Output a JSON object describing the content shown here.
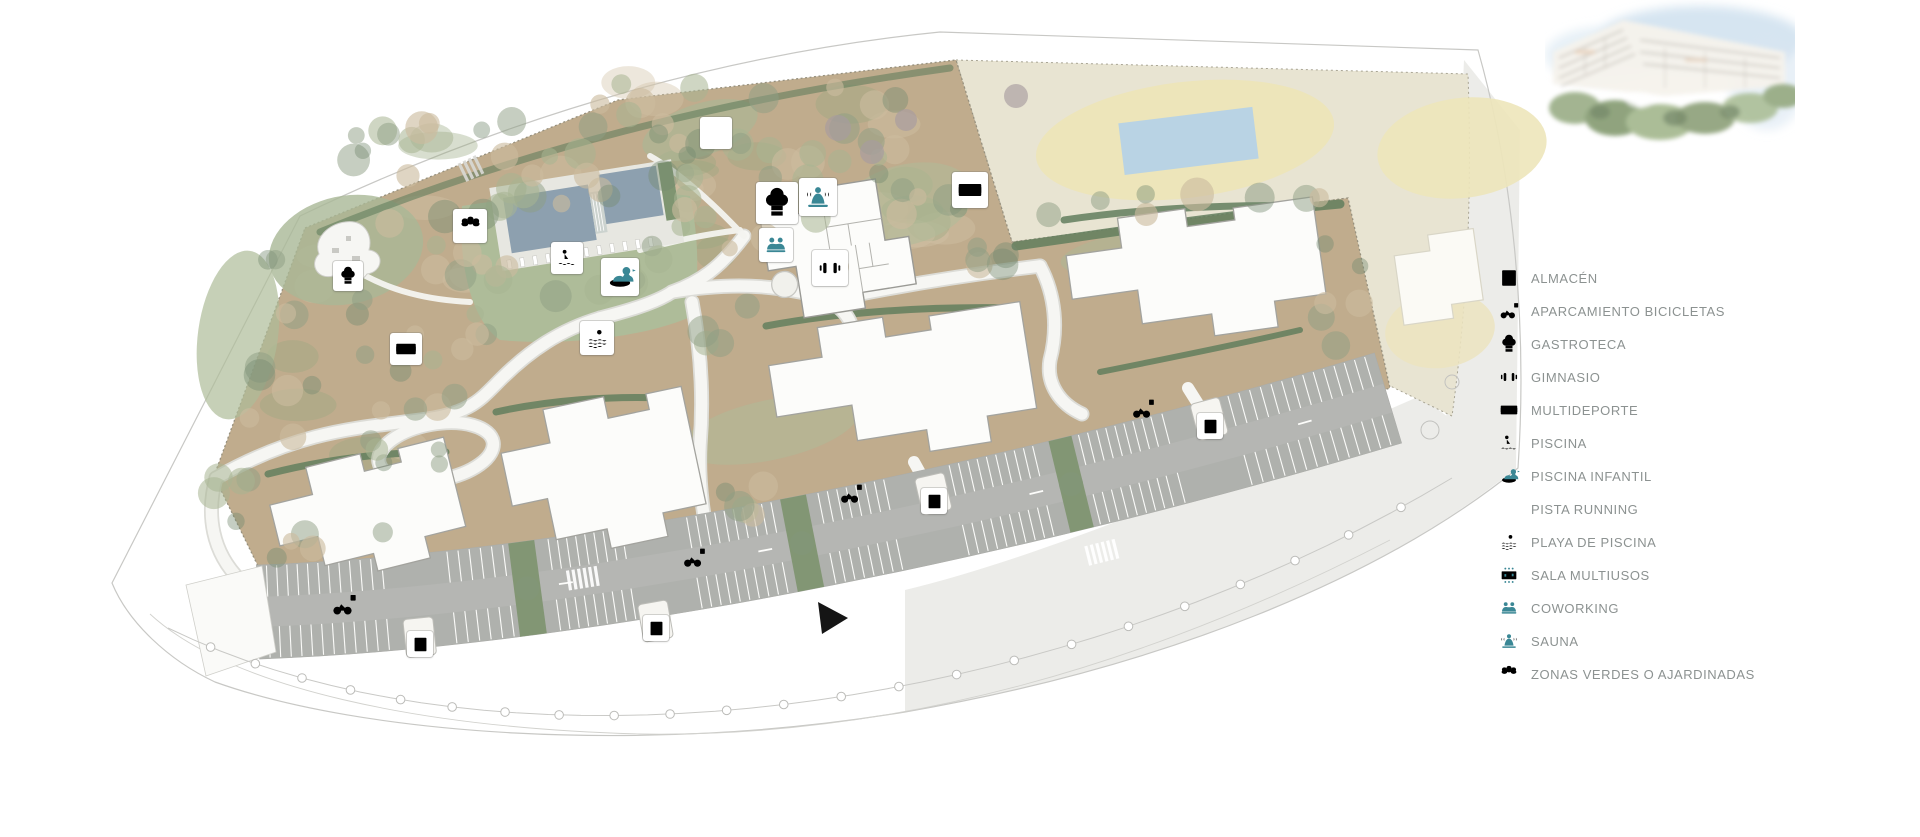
{
  "page": {
    "background": "#ffffff",
    "kind": "residential masterplan site map"
  },
  "legend": {
    "items": [
      {
        "label": "ALMACÉN",
        "icon": "almacen"
      },
      {
        "label": "APARCAMIENTO BICICLETAS",
        "icon": "bicicletas"
      },
      {
        "label": "GASTROTECA",
        "icon": "gastroteca"
      },
      {
        "label": "GIMNASIO",
        "icon": "gimnasio"
      },
      {
        "label": "MULTIDEPORTE",
        "icon": "multideporte"
      },
      {
        "label": "PISCINA",
        "icon": "piscina"
      },
      {
        "label": "PISCINA INFANTIL",
        "icon": "piscina-infantil"
      },
      {
        "label": "PISTA RUNNING",
        "icon": "pista-running"
      },
      {
        "label": "PLAYA DE PISCINA",
        "icon": "playa-piscina"
      },
      {
        "label": "SALA MULTIUSOS",
        "icon": "sala-multiusos"
      },
      {
        "label": "COWORKING",
        "icon": "coworking"
      },
      {
        "label": "SAUNA",
        "icon": "sauna"
      },
      {
        "label": "ZONAS VERDES O AJARDINADAS",
        "icon": "zonas-verdes"
      }
    ]
  },
  "map": {
    "icons": [
      {
        "type": "gastroteca",
        "x": 348,
        "y": 276,
        "s": 30,
        "g": 22,
        "boxed": true
      },
      {
        "type": "multideporte",
        "x": 406,
        "y": 349,
        "s": 32,
        "g": 26,
        "boxed": true
      },
      {
        "type": "zonas-verdes",
        "x": 470,
        "y": 226,
        "s": 34,
        "g": 27,
        "boxed": true
      },
      {
        "type": "pista-running",
        "x": 716,
        "y": 133,
        "s": 32,
        "g": 24,
        "boxed": true
      },
      {
        "type": "piscina",
        "x": 567,
        "y": 258,
        "s": 32,
        "g": 24,
        "boxed": true
      },
      {
        "type": "piscina-infantil",
        "x": 620,
        "y": 277,
        "s": 38,
        "g": 32,
        "boxed": true
      },
      {
        "type": "playa-piscina",
        "x": 597,
        "y": 338,
        "s": 34,
        "g": 27,
        "boxed": true
      },
      {
        "type": "gastroteca",
        "x": 777,
        "y": 203,
        "s": 42,
        "g": 36,
        "boxed": true
      },
      {
        "type": "sauna",
        "x": 818,
        "y": 197,
        "s": 38,
        "g": 32,
        "boxed": true
      },
      {
        "type": "coworking",
        "x": 776,
        "y": 245,
        "s": 34,
        "g": 28,
        "boxed": true
      },
      {
        "type": "gimnasio",
        "x": 830,
        "y": 268,
        "s": 36,
        "g": 28,
        "boxed": true
      },
      {
        "type": "multideporte",
        "x": 970,
        "y": 190,
        "s": 36,
        "g": 30,
        "boxed": true
      },
      {
        "type": "bicicletas",
        "x": 344,
        "y": 605,
        "s": 30,
        "g": 28,
        "boxed": false
      },
      {
        "type": "almacen",
        "x": 420,
        "y": 644,
        "s": 26,
        "g": 19,
        "boxed": true
      },
      {
        "type": "bicicletas",
        "x": 694,
        "y": 558,
        "s": 28,
        "g": 26,
        "boxed": false
      },
      {
        "type": "almacen",
        "x": 656,
        "y": 628,
        "s": 26,
        "g": 19,
        "boxed": true
      },
      {
        "type": "bicicletas",
        "x": 851,
        "y": 494,
        "s": 28,
        "g": 26,
        "boxed": false
      },
      {
        "type": "almacen",
        "x": 934,
        "y": 501,
        "s": 26,
        "g": 19,
        "boxed": true
      },
      {
        "type": "bicicletas",
        "x": 1143,
        "y": 409,
        "s": 28,
        "g": 26,
        "boxed": false
      },
      {
        "type": "almacen",
        "x": 1210,
        "y": 426,
        "s": 26,
        "g": 19,
        "boxed": true
      }
    ],
    "cursor": {
      "points": "818,602 848,618 822,634"
    },
    "features": [
      "site-terrain",
      "neighbor-parcel",
      "neighbor-pool",
      "main-pool",
      "kids-pool",
      "amenities-building",
      "apartment-block-1",
      "apartment-block-2",
      "apartment-block-3",
      "apartment-block-4",
      "playground",
      "parking-lot",
      "internal-roads",
      "perimeter-sidewalk"
    ]
  },
  "colors": {
    "icon_teal": "#3a8795",
    "legend_text": "#8c9291",
    "terrain_tan": "#c0ac8d",
    "terrain_light": "#d1c4a7",
    "lawn_green": "#aebc99",
    "lawn_dark": "#7f9571",
    "hedge_green": "#637f5e",
    "neighbor_beige": "#e8e4d2",
    "sand_yellow": "#ede5ba",
    "pool_slate": "#8da0af",
    "neighbor_pool_blue": "#b9d3e4",
    "road_white": "#f6f6f3",
    "road_casing": "#dcdcd7",
    "parking_gray": "#b5b6b3",
    "stall_gray": "#aeb0ac",
    "stall_line": "#fbfbf9",
    "band_gray": "#ecece9",
    "outline_gray": "#c8c8c5",
    "building_fill": "#fcfcfa",
    "building_stroke": "#a3a39e",
    "tree_tan": "rgba(203,188,158,0.62)",
    "tree_sage": "rgba(168,180,146,0.55)",
    "tree_gray_green": "rgba(142,158,132,0.5)",
    "tree_deep": "rgba(117,139,112,0.42)",
    "tree_purple": "rgba(167,155,160,0.65)",
    "cursor_black": "#151515"
  }
}
